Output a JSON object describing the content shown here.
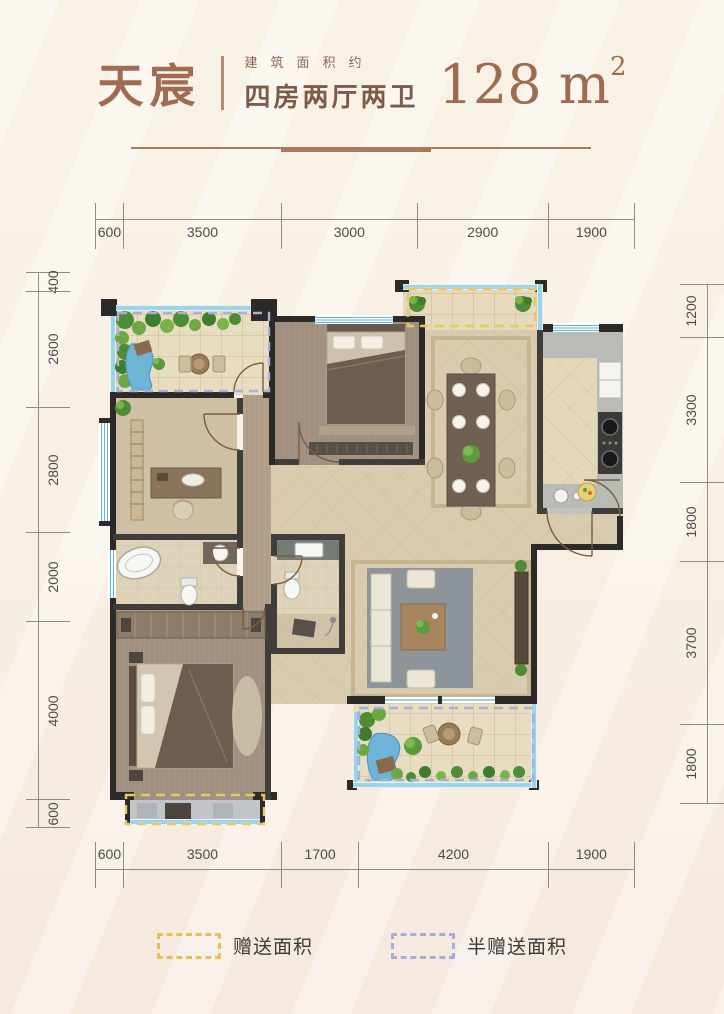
{
  "header": {
    "name": "天宸",
    "area_label": "建筑面积约",
    "layout_label": "四房两厅两卫",
    "area_value": "128 m",
    "area_sup": "2"
  },
  "dimensions": {
    "top": [
      "600",
      "3500",
      "3000",
      "2900",
      "1900"
    ],
    "bottom": [
      "600",
      "3500",
      "1700",
      "4200",
      "1900"
    ],
    "left": [
      "400",
      "2600",
      "2800",
      "2000",
      "4000",
      "600"
    ],
    "right": [
      "1200",
      "3300",
      "1800",
      "3700",
      "1800"
    ]
  },
  "legend": {
    "gift": "赠送面积",
    "half_gift": "半赠送面积"
  },
  "colors": {
    "title_brown": "#9f6c52",
    "gift_dash": "#e8c764",
    "half_gift_dash": "#a9b0d8",
    "window_blue": "#5ab6d4",
    "wall_dark": "#2b2a28"
  }
}
